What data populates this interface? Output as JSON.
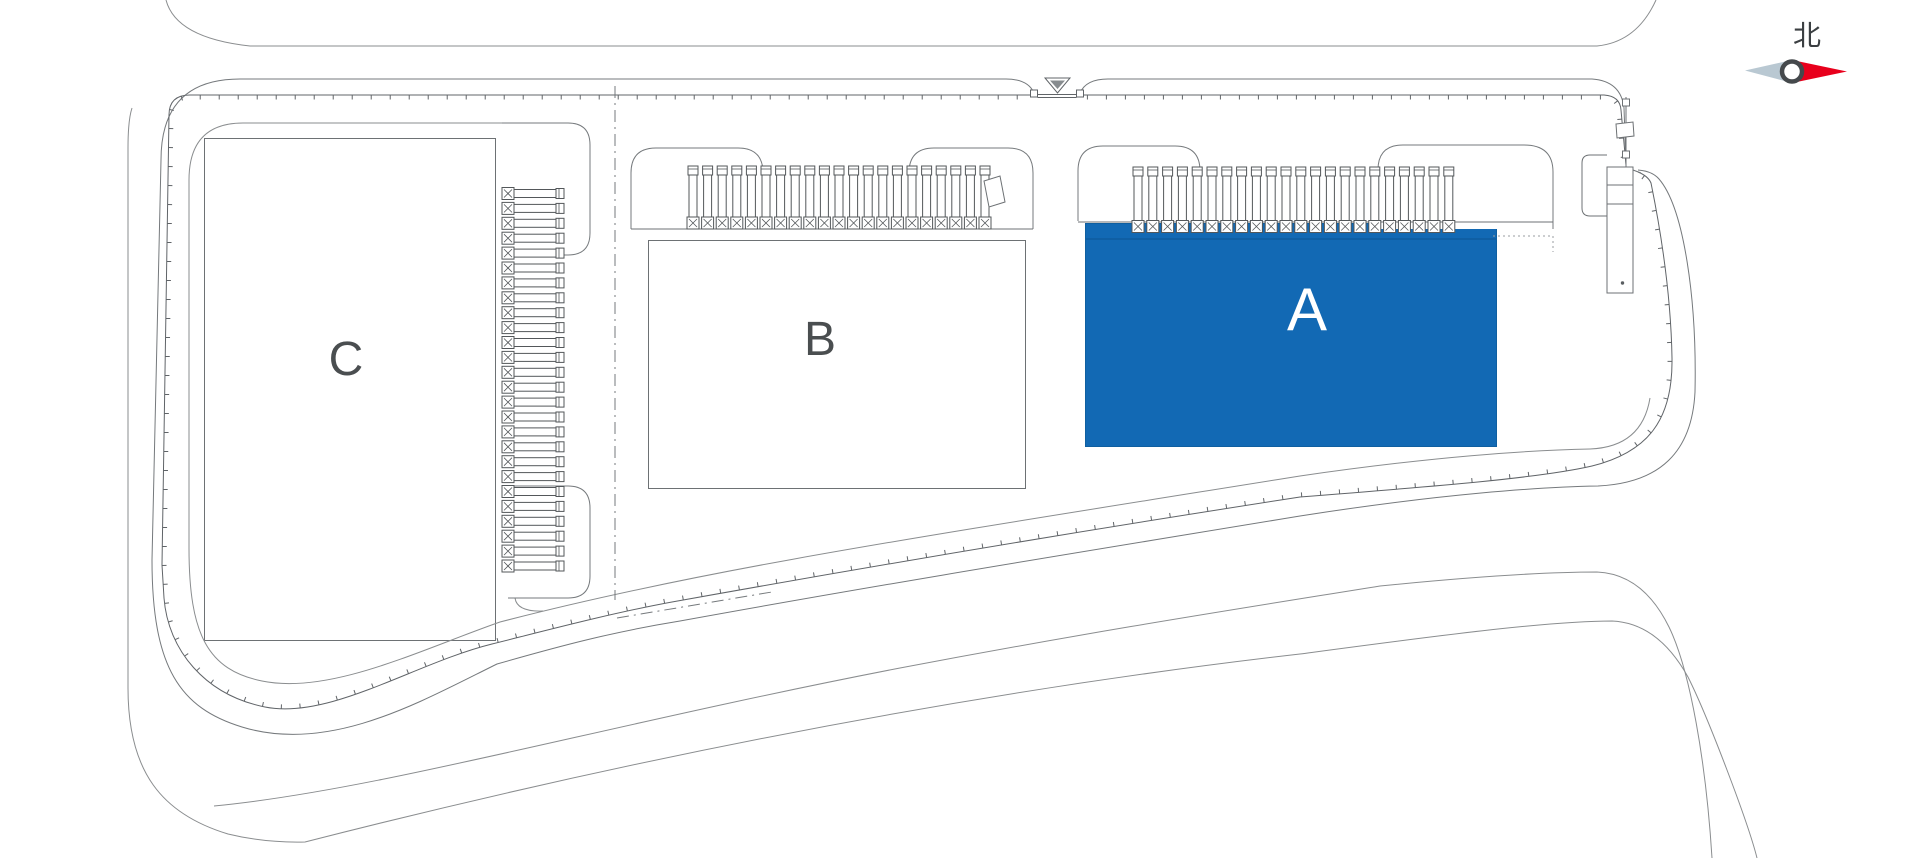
{
  "plan": {
    "type": "site-plan",
    "compass": {
      "north_label": "北"
    },
    "buildings": [
      {
        "id": "a",
        "label": "A",
        "fill": "#1269b4",
        "label_color": "#ffffff",
        "highlighted": true
      },
      {
        "id": "b",
        "label": "B",
        "fill": "#ffffff",
        "label_color": "#4a4e50",
        "highlighted": false
      },
      {
        "id": "c",
        "label": "C",
        "fill": "#ffffff",
        "label_color": "#4a4e50",
        "highlighted": false
      }
    ],
    "docks": {
      "a_count": 22,
      "b_count": 21,
      "c_count": 26
    },
    "colors": {
      "highlight_blue": "#1269b4",
      "highlight_blue_edge": "#0e5c9f",
      "line": "#75797c",
      "fence": "#606468",
      "road": "#8a8d8f",
      "dock": "#53575a",
      "compass_red": "#e8001c",
      "compass_gray": "#b9c8d2",
      "compass_ring": "#45494c"
    }
  }
}
